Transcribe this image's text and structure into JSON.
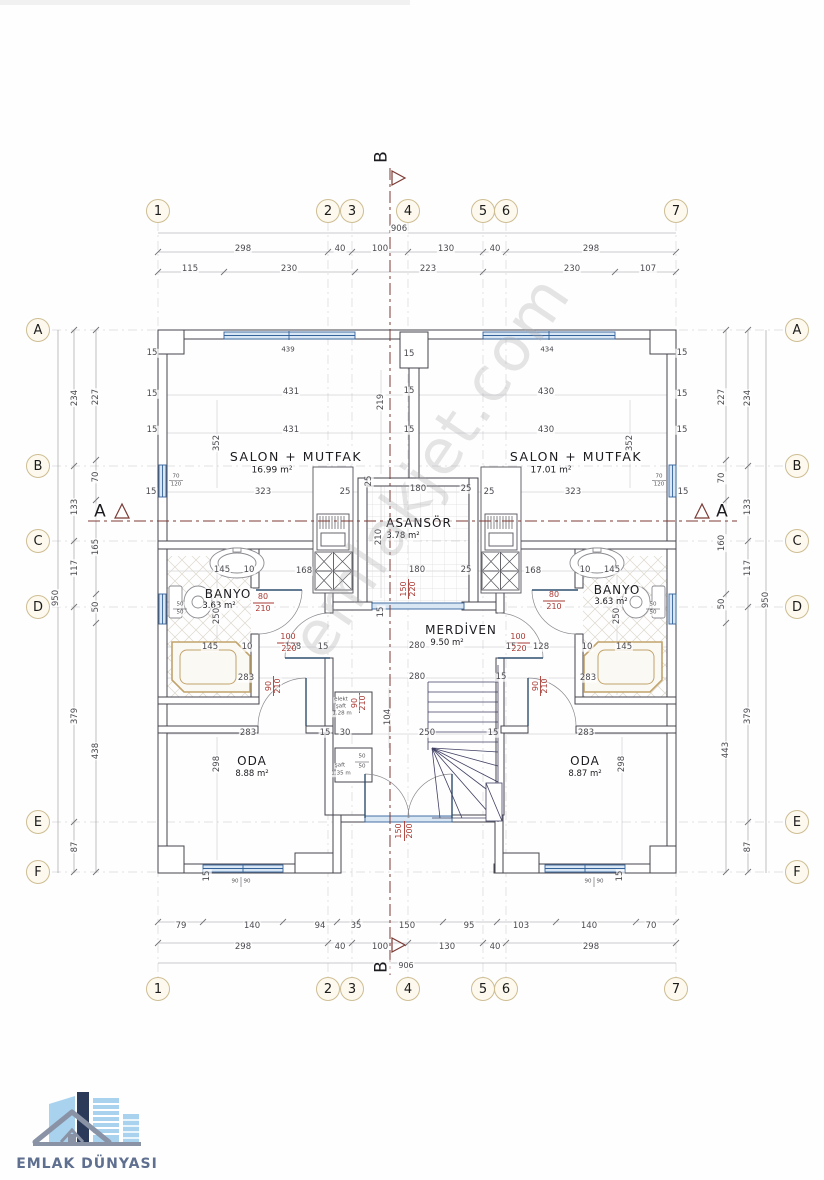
{
  "watermark": "emlakjet.com",
  "logo": {
    "text": "EMLAK DÜNYASI"
  },
  "colors": {
    "wall": "#45454e",
    "dim_line": "#95959b",
    "red": "#a93a34",
    "window_blue": "#34639c",
    "window_fill": "#d9e6f3",
    "section": "#7c3b35",
    "bubble_fill": "#fdf9ee",
    "bubble_stroke": "#cdbd92",
    "logo_text": "#5f6f8f",
    "logo_light_blue": "#a9d2ef",
    "logo_navy": "#2c3a5a",
    "logo_gray": "#8a93a6"
  },
  "rooms": [
    {
      "name": "SALON + MUTFAK",
      "area": "16.99 m²",
      "unit": "left"
    },
    {
      "name": "SALON + MUTFAK",
      "area": "17.01 m²",
      "unit": "right"
    },
    {
      "name": "BANYO",
      "area": "3.63 m²",
      "unit": "left"
    },
    {
      "name": "BANYO",
      "area": "3.63 m²",
      "unit": "right"
    },
    {
      "name": "ODA",
      "area": "8.88 m²",
      "unit": "left"
    },
    {
      "name": "ODA",
      "area": "8.87 m²",
      "unit": "right"
    },
    {
      "name": "ASANSÖR",
      "area": "3.78 m²",
      "unit": "core"
    },
    {
      "name": "MERDİVEN",
      "area": "9.50 m²",
      "unit": "core"
    },
    {
      "name": "elekt şaft",
      "area": "1.28 m",
      "unit": "core"
    },
    {
      "name": "şaft",
      "area": "1.35 m",
      "unit": "core"
    }
  ],
  "grid_bubbles": [
    {
      "t": "1",
      "x": 158,
      "y": 211
    },
    {
      "t": "2",
      "x": 328,
      "y": 211
    },
    {
      "t": "3",
      "x": 352,
      "y": 211
    },
    {
      "t": "4",
      "x": 408,
      "y": 211
    },
    {
      "t": "5",
      "x": 483,
      "y": 211
    },
    {
      "t": "6",
      "x": 506,
      "y": 211
    },
    {
      "t": "7",
      "x": 676,
      "y": 211
    },
    {
      "t": "1",
      "x": 158,
      "y": 989
    },
    {
      "t": "2",
      "x": 328,
      "y": 989
    },
    {
      "t": "3",
      "x": 352,
      "y": 989
    },
    {
      "t": "4",
      "x": 408,
      "y": 989
    },
    {
      "t": "5",
      "x": 483,
      "y": 989
    },
    {
      "t": "6",
      "x": 506,
      "y": 989
    },
    {
      "t": "7",
      "x": 676,
      "y": 989
    },
    {
      "t": "A",
      "x": 38,
      "y": 330
    },
    {
      "t": "B",
      "x": 38,
      "y": 466
    },
    {
      "t": "C",
      "x": 38,
      "y": 541
    },
    {
      "t": "D",
      "x": 38,
      "y": 607
    },
    {
      "t": "E",
      "x": 38,
      "y": 822
    },
    {
      "t": "F",
      "x": 38,
      "y": 872
    },
    {
      "t": "A",
      "x": 797,
      "y": 330
    },
    {
      "t": "B",
      "x": 797,
      "y": 466
    },
    {
      "t": "C",
      "x": 797,
      "y": 541
    },
    {
      "t": "D",
      "x": 797,
      "y": 607
    },
    {
      "t": "E",
      "x": 797,
      "y": 822
    },
    {
      "t": "F",
      "x": 797,
      "y": 872
    }
  ],
  "labels": [
    {
      "t": "906",
      "x": 399,
      "y": 229
    },
    {
      "t": "298",
      "x": 243,
      "y": 249
    },
    {
      "t": "40",
      "x": 340,
      "y": 249
    },
    {
      "t": "100",
      "x": 380,
      "y": 249
    },
    {
      "t": "130",
      "x": 446,
      "y": 249
    },
    {
      "t": "40",
      "x": 495,
      "y": 249
    },
    {
      "t": "298",
      "x": 591,
      "y": 249
    },
    {
      "t": "115",
      "x": 190,
      "y": 269
    },
    {
      "t": "230",
      "x": 289,
      "y": 269
    },
    {
      "t": "223",
      "x": 428,
      "y": 269
    },
    {
      "t": "230",
      "x": 572,
      "y": 269
    },
    {
      "t": "107",
      "x": 648,
      "y": 269
    },
    {
      "t": "79",
      "x": 181,
      "y": 926
    },
    {
      "t": "140",
      "x": 252,
      "y": 926
    },
    {
      "t": "94",
      "x": 320,
      "y": 926
    },
    {
      "t": "35",
      "x": 356,
      "y": 926
    },
    {
      "t": "150",
      "x": 407,
      "y": 926
    },
    {
      "t": "95",
      "x": 469,
      "y": 926
    },
    {
      "t": "103",
      "x": 521,
      "y": 926
    },
    {
      "t": "140",
      "x": 589,
      "y": 926
    },
    {
      "t": "70",
      "x": 651,
      "y": 926
    },
    {
      "t": "298",
      "x": 243,
      "y": 947
    },
    {
      "t": "40",
      "x": 340,
      "y": 947
    },
    {
      "t": "100",
      "x": 380,
      "y": 947
    },
    {
      "t": "130",
      "x": 447,
      "y": 947
    },
    {
      "t": "40",
      "x": 495,
      "y": 947
    },
    {
      "t": "298",
      "x": 591,
      "y": 947
    },
    {
      "t": "906",
      "x": 406,
      "y": 966,
      "s": 8
    },
    {
      "t": "950",
      "x": 56,
      "y": 598,
      "r": -90
    },
    {
      "t": "234",
      "x": 75,
      "y": 398,
      "r": -90
    },
    {
      "t": "133",
      "x": 75,
      "y": 507,
      "r": -90
    },
    {
      "t": "117",
      "x": 75,
      "y": 568,
      "r": -90
    },
    {
      "t": "379",
      "x": 75,
      "y": 716,
      "r": -90
    },
    {
      "t": "87",
      "x": 75,
      "y": 847,
      "r": -90
    },
    {
      "t": "227",
      "x": 96,
      "y": 397,
      "r": -90
    },
    {
      "t": "70",
      "x": 96,
      "y": 477,
      "r": -90
    },
    {
      "t": "165",
      "x": 96,
      "y": 547,
      "r": -90
    },
    {
      "t": "50",
      "x": 96,
      "y": 607,
      "r": -90
    },
    {
      "t": "438",
      "x": 96,
      "y": 751,
      "r": -90
    },
    {
      "t": "950",
      "x": 766,
      "y": 600,
      "r": -90
    },
    {
      "t": "234",
      "x": 748,
      "y": 398,
      "r": -90
    },
    {
      "t": "133",
      "x": 748,
      "y": 507,
      "r": -90
    },
    {
      "t": "117",
      "x": 748,
      "y": 568,
      "r": -90
    },
    {
      "t": "379",
      "x": 748,
      "y": 716,
      "r": -90
    },
    {
      "t": "87",
      "x": 748,
      "y": 847,
      "r": -90
    },
    {
      "t": "227",
      "x": 722,
      "y": 397,
      "r": -90
    },
    {
      "t": "70",
      "x": 722,
      "y": 478,
      "r": -90
    },
    {
      "t": "160",
      "x": 722,
      "y": 543,
      "r": -90
    },
    {
      "t": "50",
      "x": 722,
      "y": 604,
      "r": -90
    },
    {
      "t": "443",
      "x": 726,
      "y": 750,
      "r": -90
    },
    {
      "t": "SALON + MUTFAK",
      "x": 296,
      "y": 457,
      "s": 12.5,
      "c": "k",
      "ls": 1.5,
      "n": "room-label-salon-left"
    },
    {
      "t": "16.99 m²",
      "x": 272,
      "y": 471,
      "s": 9,
      "c": "k",
      "n": "room-area-salon-left"
    },
    {
      "t": "SALON + MUTFAK",
      "x": 576,
      "y": 457,
      "s": 12.5,
      "c": "k",
      "ls": 1.5,
      "n": "room-label-salon-right"
    },
    {
      "t": "17.01 m²",
      "x": 551,
      "y": 471,
      "s": 9,
      "c": "k",
      "n": "room-area-salon-right"
    },
    {
      "t": "ASANSÖR",
      "x": 419,
      "y": 523,
      "s": 12,
      "c": "k",
      "ls": 1,
      "n": "room-label-asansor"
    },
    {
      "t": "3.78 m²",
      "x": 403,
      "y": 536,
      "s": 8.5,
      "c": "k",
      "n": "room-area-asansor"
    },
    {
      "t": "MERDİVEN",
      "x": 461,
      "y": 630,
      "s": 12,
      "c": "k",
      "ls": 1,
      "n": "room-label-merdiven"
    },
    {
      "t": "9.50 m²",
      "x": 447,
      "y": 643,
      "s": 8.5,
      "c": "k",
      "n": "room-area-merdiven"
    },
    {
      "t": "BANYO",
      "x": 228,
      "y": 594,
      "s": 12,
      "c": "k",
      "ls": 1,
      "n": "room-label-banyo-left"
    },
    {
      "t": "3.63 m²",
      "x": 219,
      "y": 606,
      "s": 8.5,
      "c": "k",
      "n": "room-area-banyo-left"
    },
    {
      "t": "BANYO",
      "x": 617,
      "y": 590,
      "s": 12,
      "c": "k",
      "ls": 1,
      "n": "room-label-banyo-right"
    },
    {
      "t": "3.63 m²",
      "x": 611,
      "y": 602,
      "s": 8.5,
      "c": "k",
      "n": "room-area-banyo-right"
    },
    {
      "t": "ODA",
      "x": 252,
      "y": 761,
      "s": 12,
      "c": "k",
      "ls": 1,
      "n": "room-label-oda-left"
    },
    {
      "t": "8.88 m²",
      "x": 252,
      "y": 774,
      "s": 8.5,
      "c": "k",
      "n": "room-area-oda-left"
    },
    {
      "t": "ODA",
      "x": 585,
      "y": 761,
      "s": 12,
      "c": "k",
      "ls": 1,
      "n": "room-label-oda-right"
    },
    {
      "t": "8.87 m²",
      "x": 585,
      "y": 774,
      "s": 8.5,
      "c": "k",
      "n": "room-area-oda-right"
    },
    {
      "t": "elekt",
      "x": 341,
      "y": 700,
      "s": 5.5,
      "c": "t",
      "n": "shaft-label"
    },
    {
      "t": "şaft",
      "x": 341,
      "y": 707,
      "s": 5.5,
      "c": "t",
      "n": "shaft-label"
    },
    {
      "t": "1.28 m",
      "x": 342,
      "y": 714,
      "s": 5.5,
      "c": "t",
      "n": "shaft-label"
    },
    {
      "t": "şaft",
      "x": 340,
      "y": 766,
      "s": 5.5,
      "c": "t",
      "n": "shaft-label"
    },
    {
      "t": "1.35 m",
      "x": 341,
      "y": 774,
      "s": 5.5,
      "c": "t",
      "n": "shaft-label"
    },
    {
      "t": "431",
      "x": 291,
      "y": 392
    },
    {
      "t": "431",
      "x": 291,
      "y": 430
    },
    {
      "t": "352",
      "x": 217,
      "y": 443,
      "r": -90
    },
    {
      "t": "323",
      "x": 263,
      "y": 492
    },
    {
      "t": "25",
      "x": 345,
      "y": 492
    },
    {
      "t": "219",
      "x": 381,
      "y": 402,
      "r": -90
    },
    {
      "t": "15",
      "x": 409,
      "y": 391
    },
    {
      "t": "15",
      "x": 409,
      "y": 430
    },
    {
      "t": "430",
      "x": 546,
      "y": 392
    },
    {
      "t": "430",
      "x": 546,
      "y": 430
    },
    {
      "t": "352",
      "x": 630,
      "y": 443,
      "r": -90
    },
    {
      "t": "323",
      "x": 573,
      "y": 492
    },
    {
      "t": "25",
      "x": 489,
      "y": 492
    },
    {
      "t": "180",
      "x": 418,
      "y": 489
    },
    {
      "t": "25",
      "x": 466,
      "y": 489
    },
    {
      "t": "180",
      "x": 417,
      "y": 570
    },
    {
      "t": "25",
      "x": 466,
      "y": 570
    },
    {
      "t": "210",
      "x": 379,
      "y": 537,
      "r": -90
    },
    {
      "t": "25",
      "x": 369,
      "y": 481,
      "r": -90
    },
    {
      "t": "168",
      "x": 304,
      "y": 571
    },
    {
      "t": "168",
      "x": 533,
      "y": 571
    },
    {
      "t": "145",
      "x": 222,
      "y": 570
    },
    {
      "t": "10",
      "x": 249,
      "y": 570
    },
    {
      "t": "10",
      "x": 585,
      "y": 570
    },
    {
      "t": "145",
      "x": 612,
      "y": 570
    },
    {
      "t": "250",
      "x": 217,
      "y": 616,
      "r": -90
    },
    {
      "t": "250",
      "x": 617,
      "y": 616,
      "r": -90
    },
    {
      "t": "145",
      "x": 210,
      "y": 647
    },
    {
      "t": "10",
      "x": 247,
      "y": 647
    },
    {
      "t": "128",
      "x": 293,
      "y": 647
    },
    {
      "t": "15",
      "x": 323,
      "y": 647
    },
    {
      "t": "280",
      "x": 417,
      "y": 646
    },
    {
      "t": "15",
      "x": 511,
      "y": 647
    },
    {
      "t": "128",
      "x": 541,
      "y": 647
    },
    {
      "t": "10",
      "x": 587,
      "y": 647
    },
    {
      "t": "145",
      "x": 624,
      "y": 647
    },
    {
      "t": "283",
      "x": 246,
      "y": 678
    },
    {
      "t": "280",
      "x": 417,
      "y": 677
    },
    {
      "t": "283",
      "x": 588,
      "y": 678
    },
    {
      "t": "283",
      "x": 248,
      "y": 733
    },
    {
      "t": "15",
      "x": 325,
      "y": 733
    },
    {
      "t": "30",
      "x": 345,
      "y": 733
    },
    {
      "t": "250",
      "x": 427,
      "y": 733
    },
    {
      "t": "15",
      "x": 493,
      "y": 733
    },
    {
      "t": "283",
      "x": 586,
      "y": 733
    },
    {
      "t": "104",
      "x": 388,
      "y": 717,
      "r": -90
    },
    {
      "t": "298",
      "x": 217,
      "y": 764,
      "r": -90
    },
    {
      "t": "298",
      "x": 622,
      "y": 764,
      "r": -90
    },
    {
      "t": "15",
      "x": 152,
      "y": 353
    },
    {
      "t": "15",
      "x": 152,
      "y": 394
    },
    {
      "t": "15",
      "x": 152,
      "y": 430
    },
    {
      "t": "15",
      "x": 151,
      "y": 492
    },
    {
      "t": "15",
      "x": 682,
      "y": 353
    },
    {
      "t": "15",
      "x": 682,
      "y": 394
    },
    {
      "t": "15",
      "x": 682,
      "y": 430
    },
    {
      "t": "15",
      "x": 683,
      "y": 492
    },
    {
      "t": "15",
      "x": 409,
      "y": 354
    },
    {
      "t": "15",
      "x": 501,
      "y": 677
    },
    {
      "t": "15",
      "x": 381,
      "y": 612,
      "r": -90
    },
    {
      "t": "15",
      "x": 207,
      "y": 876,
      "r": -90
    },
    {
      "t": "15",
      "x": 620,
      "y": 876,
      "r": -90
    },
    {
      "t": "439",
      "x": 288,
      "y": 350,
      "s": 7
    },
    {
      "t": "434",
      "x": 547,
      "y": 350,
      "s": 7
    },
    {
      "t": "90",
      "x": 235,
      "y": 882,
      "s": 5.5,
      "c": "t"
    },
    {
      "t": "90",
      "x": 247,
      "y": 882,
      "s": 5.5,
      "c": "t"
    },
    {
      "t": "90",
      "x": 588,
      "y": 882,
      "s": 5.5,
      "c": "t"
    },
    {
      "t": "90",
      "x": 600,
      "y": 882,
      "s": 5.5,
      "c": "t"
    },
    {
      "t": "70",
      "x": 176,
      "y": 477,
      "s": 5.5,
      "c": "t"
    },
    {
      "t": "120",
      "x": 176,
      "y": 485,
      "s": 5.5,
      "c": "t"
    },
    {
      "t": "70",
      "x": 659,
      "y": 477,
      "s": 5.5,
      "c": "t"
    },
    {
      "t": "120",
      "x": 659,
      "y": 485,
      "s": 5.5,
      "c": "t"
    },
    {
      "t": "50",
      "x": 180,
      "y": 605,
      "s": 5.5,
      "c": "t"
    },
    {
      "t": "50",
      "x": 180,
      "y": 613,
      "s": 5.5,
      "c": "t"
    },
    {
      "t": "50",
      "x": 653,
      "y": 605,
      "s": 5.5,
      "c": "t"
    },
    {
      "t": "50",
      "x": 653,
      "y": 613,
      "s": 5.5,
      "c": "t"
    },
    {
      "t": "50",
      "x": 362,
      "y": 757,
      "s": 5.5,
      "c": "t"
    },
    {
      "t": "50",
      "x": 362,
      "y": 767,
      "s": 5.5,
      "c": "t"
    },
    {
      "t": "80",
      "x": 263,
      "y": 597,
      "s": 8,
      "c": "r",
      "n": "door-size-label"
    },
    {
      "t": "210",
      "x": 263,
      "y": 609,
      "s": 8,
      "c": "r",
      "n": "door-size-label"
    },
    {
      "t": "80",
      "x": 554,
      "y": 595,
      "s": 8,
      "c": "r",
      "n": "door-size-label"
    },
    {
      "t": "210",
      "x": 554,
      "y": 607,
      "s": 8,
      "c": "r",
      "n": "door-size-label"
    },
    {
      "t": "100",
      "x": 288,
      "y": 637,
      "s": 8,
      "c": "r",
      "n": "door-size-label"
    },
    {
      "t": "220",
      "x": 289,
      "y": 649,
      "s": 8,
      "c": "r",
      "n": "door-size-label"
    },
    {
      "t": "100",
      "x": 518,
      "y": 637,
      "s": 8,
      "c": "r",
      "n": "door-size-label"
    },
    {
      "t": "220",
      "x": 519,
      "y": 649,
      "s": 8,
      "c": "r",
      "n": "door-size-label"
    },
    {
      "t": "90",
      "x": 269,
      "y": 686,
      "s": 8,
      "c": "r",
      "r": -90,
      "n": "door-size-label"
    },
    {
      "t": "210",
      "x": 278,
      "y": 686,
      "s": 8,
      "c": "r",
      "r": -90,
      "n": "door-size-label"
    },
    {
      "t": "90",
      "x": 536,
      "y": 686,
      "s": 8,
      "c": "r",
      "r": -90,
      "n": "door-size-label"
    },
    {
      "t": "210",
      "x": 545,
      "y": 686,
      "s": 8,
      "c": "r",
      "r": -90,
      "n": "door-size-label"
    },
    {
      "t": "90",
      "x": 355,
      "y": 703,
      "s": 8,
      "c": "r",
      "r": -90,
      "n": "door-size-label"
    },
    {
      "t": "210",
      "x": 363,
      "y": 703,
      "s": 8,
      "c": "r",
      "r": -90,
      "n": "door-size-label"
    },
    {
      "t": "150",
      "x": 404,
      "y": 589,
      "s": 8,
      "c": "r",
      "r": -90,
      "n": "door-size-label"
    },
    {
      "t": "220",
      "x": 413,
      "y": 589,
      "s": 8,
      "c": "r",
      "r": -90,
      "n": "door-size-label"
    },
    {
      "t": "150",
      "x": 399,
      "y": 831,
      "s": 8,
      "c": "r",
      "r": -90,
      "n": "door-size-label"
    },
    {
      "t": "200",
      "x": 410,
      "y": 831,
      "s": 8,
      "c": "r",
      "r": -90,
      "n": "door-size-label"
    },
    {
      "t": "B",
      "x": 382,
      "y": 157,
      "s": 17,
      "c": "k",
      "r": -90,
      "n": "section-marker-b-top"
    },
    {
      "t": "B",
      "x": 382,
      "y": 967,
      "s": 17,
      "c": "k",
      "r": -90,
      "n": "section-marker-b-bottom"
    },
    {
      "t": "A",
      "x": 100,
      "y": 512,
      "s": 17,
      "c": "k",
      "n": "section-marker-a-left"
    },
    {
      "t": "A",
      "x": 722,
      "y": 512,
      "s": 17,
      "c": "k",
      "n": "section-marker-a-right"
    }
  ]
}
